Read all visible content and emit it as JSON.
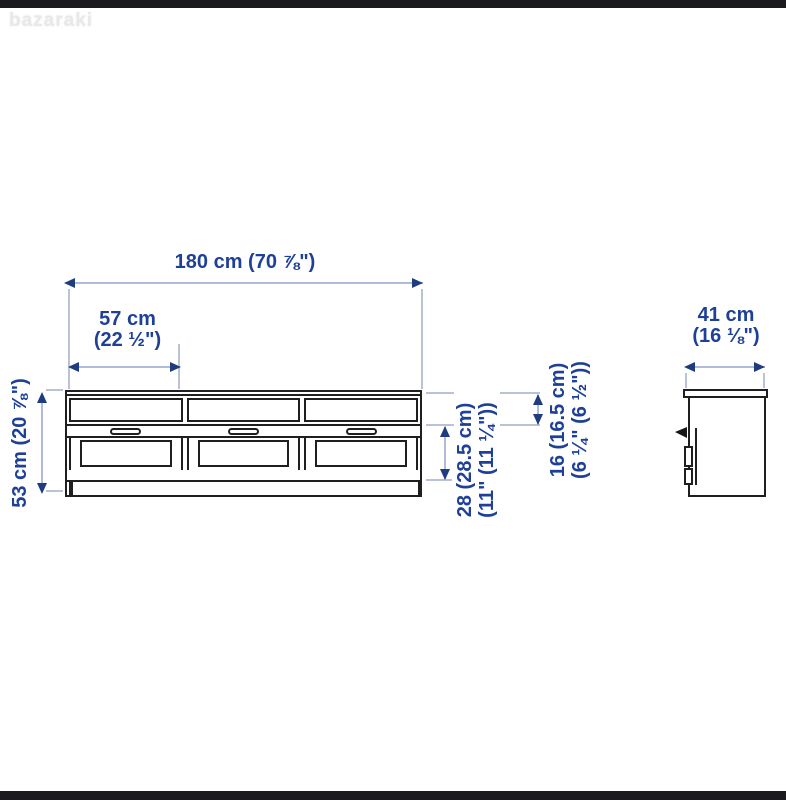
{
  "watermark": {
    "text": "bazaraki"
  },
  "colors": {
    "bg": "#ffffff",
    "ink": "#1f1f1f",
    "bar": "#1b1b1d",
    "watermark": "#e8e8e8",
    "dim_text": "#1e4097",
    "dim_line": "#b0badb",
    "arrowhead": "#1f3c80",
    "ext_line": "#b9c2d6"
  },
  "product": {
    "type": "tv-bench-dimension-diagram",
    "views": {
      "front": "front-view",
      "side": "side-view"
    },
    "front_view": {
      "shelf_openings": 3,
      "drawers": 3,
      "handles": 3
    }
  },
  "dims": {
    "width_total": "180 cm (70 ⅞\")",
    "drawer_width_l1": "57 cm",
    "drawer_width_l2": "(22 ½\")",
    "height_total": "53 cm (20 ⅞\")",
    "drawer_height_l1": "28 (28.5 cm)",
    "drawer_height_l2": "(11\" (11 ¼\"))",
    "shelf_height_l1": "16 (16.5 cm)",
    "shelf_height_l2": "(6 ¼\" (6 ½\"))",
    "depth_l1": "41 cm",
    "depth_l2": "(16 ⅛\")"
  }
}
